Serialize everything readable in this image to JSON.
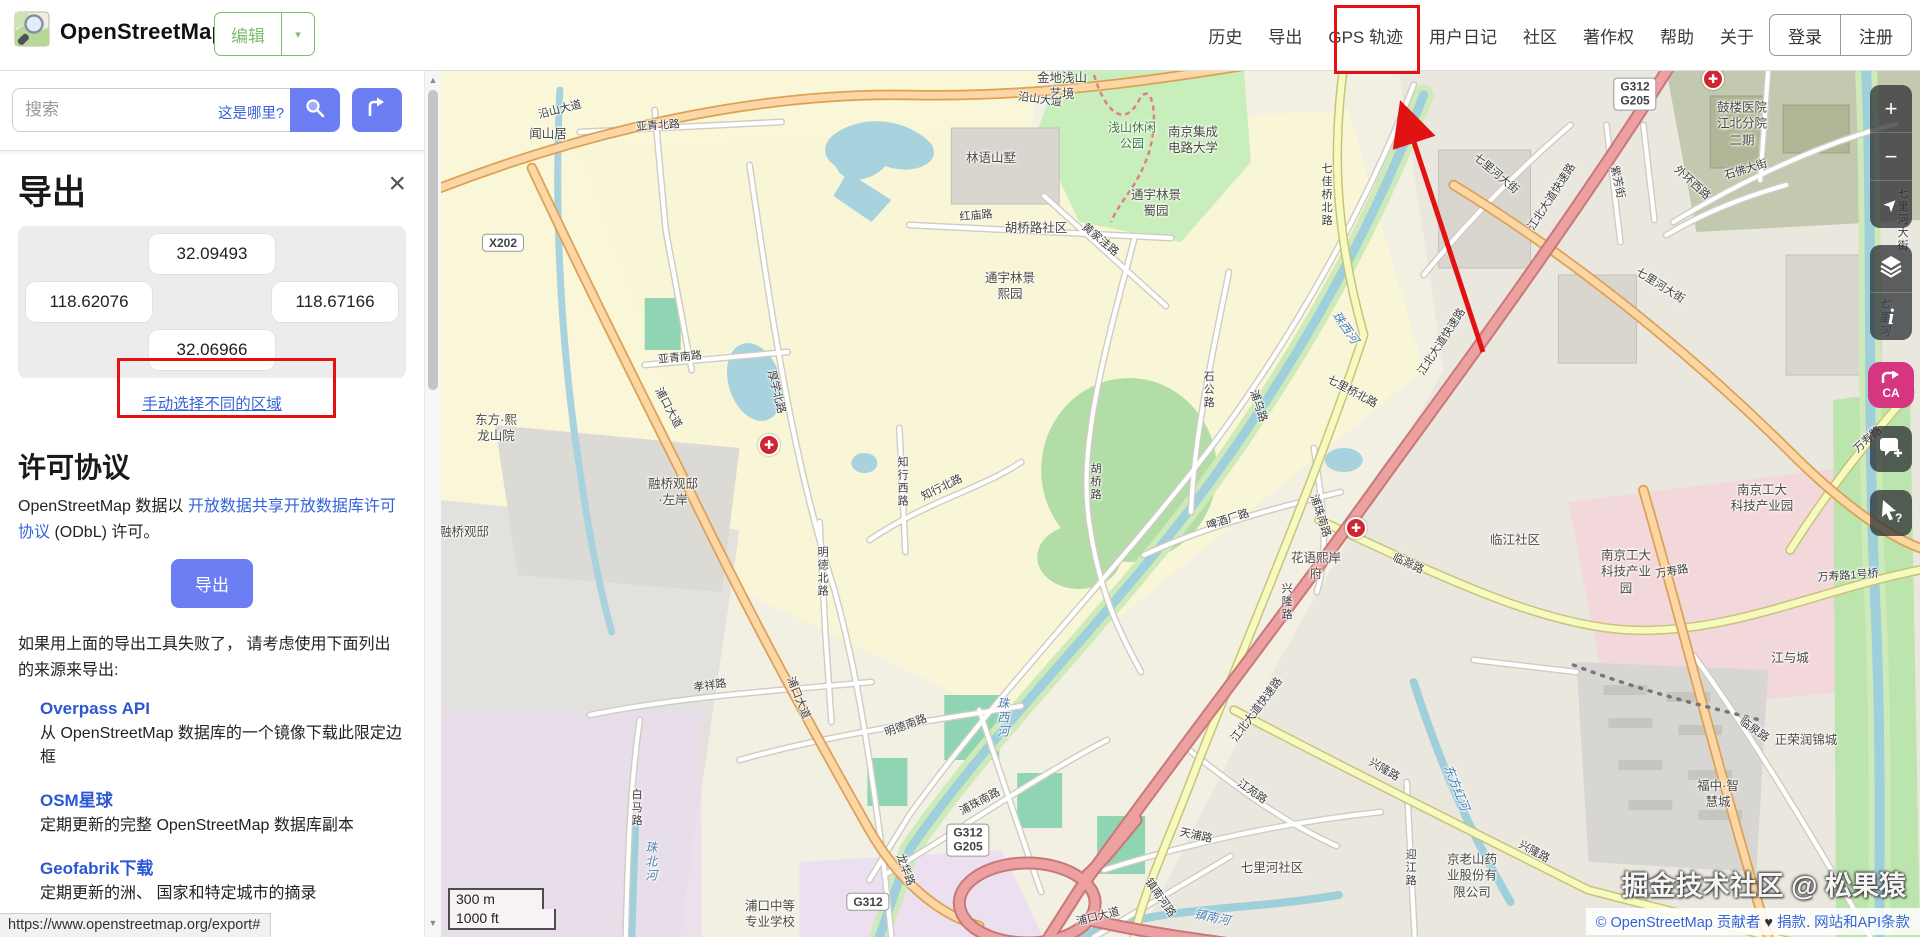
{
  "header": {
    "title": "OpenStreetMap",
    "edit_label": "编辑",
    "edit_caret": "▾",
    "nav": [
      "历史",
      "导出",
      "GPS 轨迹",
      "用户日记",
      "社区",
      "著作权",
      "帮助",
      "关于"
    ],
    "login": "登录",
    "signup": "注册"
  },
  "search": {
    "placeholder": "搜索",
    "where_link": "这是哪里?"
  },
  "export_panel": {
    "title": "导出",
    "close_glyph": "×",
    "bbox": {
      "north": "32.09493",
      "west": "118.62076",
      "east": "118.67166",
      "south": "32.06966"
    },
    "manual_link": "手动选择不同的区域",
    "license_heading": "许可协议",
    "license_pre": "OpenStreetMap 数据以 ",
    "license_link": "开放数据共享开放数据库许可协议",
    "license_post": " (ODbL) 许可。",
    "export_button": "导出",
    "fallback_text": "如果用上面的导出工具失败了， 请考虑使用下面列出的来源来导出:",
    "sources": [
      {
        "name": "Overpass API",
        "desc": "从 OpenStreetMap 数据库的一个镜像下载此限定边框"
      },
      {
        "name": "OSM星球",
        "desc": "定期更新的完整 OpenStreetMap 数据库副本"
      },
      {
        "name": "Geofabrik下载",
        "desc": "定期更新的洲、 国家和特定城市的摘录"
      }
    ]
  },
  "map": {
    "scale_metric": "300 m",
    "scale_imperial": "1000 ft",
    "watermark": "掘金技术社区 @ 松果猿",
    "attribution": {
      "copyright": "© OpenStreetMap 贡献者",
      "heart": "♥",
      "donate": "捐款",
      "sep": ". ",
      "terms": "网站和API条款"
    },
    "controls": {
      "zoom_in": "+",
      "zoom_out": "−",
      "locate": "➤",
      "map_key": "i",
      "translate_text": "CA",
      "query": "?"
    },
    "labels": [
      {
        "t": "X202",
        "x": 63,
        "y": 173,
        "c": "badge"
      },
      {
        "t": "G312\nG205",
        "x": 1195,
        "y": 24,
        "c": "badge"
      },
      {
        "t": "G312\nG205",
        "x": 528,
        "y": 770,
        "c": "badge"
      },
      {
        "t": "G312",
        "x": 428,
        "y": 832,
        "c": "badge"
      },
      {
        "t": "沿山大道",
        "x": 120,
        "y": 40,
        "r": -14,
        "c": "road"
      },
      {
        "t": "沿山大道",
        "x": 600,
        "y": 30,
        "r": 8,
        "c": "road"
      },
      {
        "t": "闻山居",
        "x": 108,
        "y": 64,
        "c": "place"
      },
      {
        "t": "亚青北路",
        "x": 218,
        "y": 56,
        "r": -4,
        "c": "road"
      },
      {
        "t": "亚青南路",
        "x": 240,
        "y": 288,
        "r": -6,
        "c": "road"
      },
      {
        "t": "林语山墅",
        "x": 551,
        "y": 88,
        "c": "place"
      },
      {
        "t": "浅山休闲\n公园",
        "x": 692,
        "y": 66,
        "c": "area"
      },
      {
        "t": "金地浅山\n艺境",
        "x": 622,
        "y": 16,
        "c": "place"
      },
      {
        "t": "红庙路",
        "x": 536,
        "y": 146,
        "r": -5,
        "c": "road"
      },
      {
        "t": "胡桥路社区",
        "x": 596,
        "y": 158,
        "c": "place"
      },
      {
        "t": "通宇林景\n熙园",
        "x": 570,
        "y": 216,
        "c": "place"
      },
      {
        "t": "通宇林景\n蜀园",
        "x": 716,
        "y": 133,
        "c": "place"
      },
      {
        "t": "南京集成\n电路大学",
        "x": 753,
        "y": 70,
        "c": "place"
      },
      {
        "t": "七佳桥北路",
        "x": 886,
        "y": 125,
        "v": 1,
        "c": "road"
      },
      {
        "t": "珠西河",
        "x": 905,
        "y": 258,
        "r": 55,
        "c": "water"
      },
      {
        "t": "珠西河",
        "x": 562,
        "y": 648,
        "v": 1,
        "c": "water"
      },
      {
        "t": "七里桥北路",
        "x": 912,
        "y": 322,
        "r": 28,
        "c": "road"
      },
      {
        "t": "江北大道快速路",
        "x": 1112,
        "y": 127,
        "r": -57,
        "c": "road"
      },
      {
        "t": "江北大道快速路",
        "x": 1002,
        "y": 272,
        "r": -57,
        "c": "road"
      },
      {
        "t": "江北大道快速路",
        "x": 817,
        "y": 640,
        "r": -53,
        "c": "road"
      },
      {
        "t": "鼓楼医院\n江北分院\n二期",
        "x": 1302,
        "y": 54,
        "c": "place"
      },
      {
        "t": "石佛大街",
        "x": 1306,
        "y": 100,
        "r": -17,
        "c": "road"
      },
      {
        "t": "七里河大街",
        "x": 1056,
        "y": 104,
        "r": 40,
        "c": "road"
      },
      {
        "t": "七里河大街",
        "x": 1220,
        "y": 216,
        "r": 32,
        "c": "road"
      },
      {
        "t": "七里河大街",
        "x": 1462,
        "y": 150,
        "v": 1,
        "c": "road"
      },
      {
        "t": "外环西路",
        "x": 1252,
        "y": 113,
        "r": 42,
        "c": "road"
      },
      {
        "t": "紫芳街",
        "x": 1177,
        "y": 112,
        "r": 78,
        "c": "road"
      },
      {
        "t": "七里河",
        "x": 1443,
        "y": 248,
        "v": 1,
        "c": "water"
      },
      {
        "t": "万寿路",
        "x": 1428,
        "y": 370,
        "r": -42,
        "c": "road"
      },
      {
        "t": "万寿路",
        "x": 1232,
        "y": 502,
        "r": -10,
        "c": "road"
      },
      {
        "t": "临江社区",
        "x": 1075,
        "y": 470,
        "c": "place"
      },
      {
        "t": "南京工大\n科技产业\n园",
        "x": 1186,
        "y": 502,
        "c": "place"
      },
      {
        "t": "南京工大\n科技产业园",
        "x": 1322,
        "y": 428,
        "c": "place"
      },
      {
        "t": "花语熙岸\n府",
        "x": 876,
        "y": 496,
        "c": "place"
      },
      {
        "t": "临滁路",
        "x": 968,
        "y": 494,
        "r": 25,
        "c": "road"
      },
      {
        "t": "兴隆路",
        "x": 846,
        "y": 532,
        "v": 1,
        "c": "road"
      },
      {
        "t": "兴隆路",
        "x": 944,
        "y": 700,
        "r": 30,
        "c": "road"
      },
      {
        "t": "兴隆路",
        "x": 1094,
        "y": 782,
        "r": 28,
        "c": "road"
      },
      {
        "t": "万寿路1号桥",
        "x": 1408,
        "y": 506,
        "r": -4,
        "c": "road"
      },
      {
        "t": "江与城",
        "x": 1350,
        "y": 588,
        "c": "place"
      },
      {
        "t": "临泉路",
        "x": 1314,
        "y": 660,
        "r": 35,
        "c": "road"
      },
      {
        "t": "福中·智\n慧城",
        "x": 1278,
        "y": 724,
        "c": "place"
      },
      {
        "t": "正荣润锦城",
        "x": 1366,
        "y": 670,
        "c": "place"
      },
      {
        "t": "浦口中等\n专业学校",
        "x": 330,
        "y": 844,
        "c": "place"
      },
      {
        "t": "龙华路",
        "x": 465,
        "y": 800,
        "r": 70,
        "c": "road"
      },
      {
        "t": "孝祥路",
        "x": 270,
        "y": 616,
        "r": -8,
        "c": "road"
      },
      {
        "t": "白马路",
        "x": 196,
        "y": 738,
        "v": 1,
        "c": "road"
      },
      {
        "t": "珠北河",
        "x": 210,
        "y": 792,
        "v": 1,
        "c": "water"
      },
      {
        "t": "浦口大道",
        "x": 228,
        "y": 338,
        "r": 62,
        "c": "road"
      },
      {
        "t": "浦口大道",
        "x": 358,
        "y": 628,
        "r": 68,
        "c": "road"
      },
      {
        "t": "浦口大道",
        "x": 658,
        "y": 847,
        "r": -14,
        "c": "road"
      },
      {
        "t": "厚学北路",
        "x": 336,
        "y": 322,
        "r": 76,
        "c": "road"
      },
      {
        "t": "知行西路",
        "x": 462,
        "y": 412,
        "v": 1,
        "c": "road"
      },
      {
        "t": "知行北路",
        "x": 502,
        "y": 418,
        "r": -26,
        "c": "road"
      },
      {
        "t": "明德北路",
        "x": 382,
        "y": 502,
        "v": 1,
        "c": "road"
      },
      {
        "t": "明德南路",
        "x": 466,
        "y": 656,
        "r": -20,
        "c": "road"
      },
      {
        "t": "浦珠南路",
        "x": 880,
        "y": 446,
        "r": 72,
        "c": "road"
      },
      {
        "t": "浦珠南路",
        "x": 540,
        "y": 732,
        "r": -28,
        "c": "road"
      },
      {
        "t": "啤酒厂路",
        "x": 788,
        "y": 450,
        "r": -18,
        "c": "road"
      },
      {
        "t": "浦乌路",
        "x": 818,
        "y": 336,
        "r": 72,
        "c": "road"
      },
      {
        "t": "胡桥路",
        "x": 655,
        "y": 412,
        "v": 1,
        "c": "road"
      },
      {
        "t": "石公路",
        "x": 768,
        "y": 320,
        "v": 1,
        "c": "road"
      },
      {
        "t": "黄家洼路",
        "x": 660,
        "y": 170,
        "r": 40,
        "c": "road"
      },
      {
        "t": "融桥观邸\n·左岸",
        "x": 233,
        "y": 422,
        "c": "place"
      },
      {
        "t": "融桥观邸",
        "x": 24,
        "y": 462,
        "c": "place"
      },
      {
        "t": "东方·熙\n龙山院",
        "x": 56,
        "y": 358,
        "c": "place"
      },
      {
        "t": "江苑路",
        "x": 812,
        "y": 722,
        "r": 35,
        "c": "road"
      },
      {
        "t": "天浦路",
        "x": 756,
        "y": 766,
        "r": 12,
        "c": "road"
      },
      {
        "t": "七里河社区",
        "x": 832,
        "y": 798,
        "c": "place"
      },
      {
        "t": "镇南河路",
        "x": 720,
        "y": 828,
        "r": 55,
        "c": "road"
      },
      {
        "t": "镇南河",
        "x": 772,
        "y": 848,
        "r": 12,
        "c": "water"
      },
      {
        "t": "迎江路",
        "x": 970,
        "y": 798,
        "v": 1,
        "c": "road"
      },
      {
        "t": "京老山药\n业股份有\n限公司",
        "x": 1032,
        "y": 806,
        "c": "place"
      },
      {
        "t": "东方红河",
        "x": 1016,
        "y": 718,
        "r": 68,
        "c": "water"
      },
      {
        "t": "✚",
        "x": 329,
        "y": 375,
        "c": "poi"
      },
      {
        "t": "✚",
        "x": 916,
        "y": 458,
        "c": "poi"
      },
      {
        "t": "✚",
        "x": 1273,
        "y": 9,
        "c": "poi"
      }
    ]
  },
  "statusbar": {
    "url": "https://www.openstreetmap.org/export#"
  },
  "colors": {
    "brand_green": "#7ebc6f",
    "button_blue": "#6c7ff2",
    "link_blue": "#3563d9",
    "annotation_red": "#e01212",
    "translate_pink": "#d6367f"
  }
}
